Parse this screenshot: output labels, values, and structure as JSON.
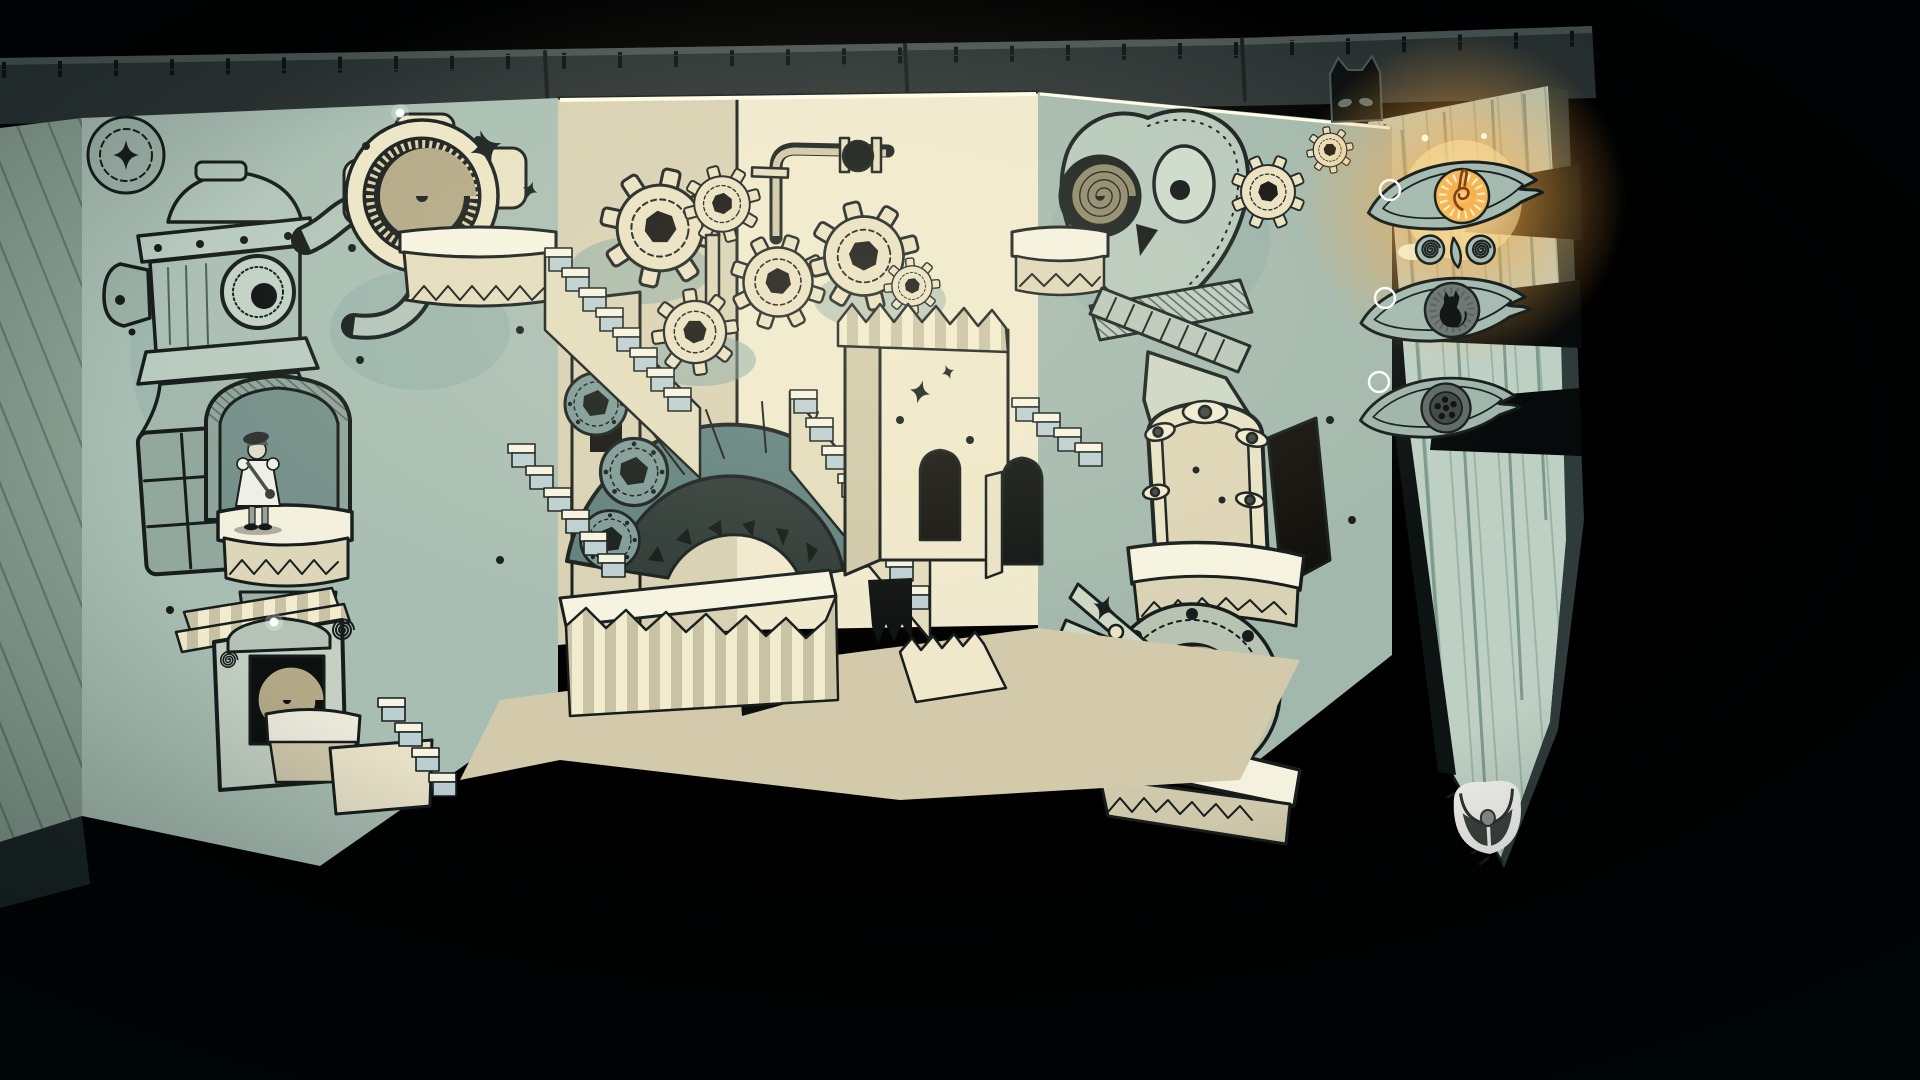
{
  "colors": {
    "background": "#000000",
    "cover_band": "#2a3232",
    "cover_edge": "#4a5452",
    "cover_tick": "#0d1312",
    "left_page_edge": "#8aa093",
    "left_wall": "#a9beb3",
    "back_wall_lit": "#f0e9cd",
    "back_wall_shade": "#d8d0b2",
    "right_wall": "#a3b8ad",
    "floor": "#d3caab",
    "paper_white": "#f6f3e1",
    "cream": "#e6dec0",
    "cream_shadow": "#c9c2a6",
    "shadow_blue": "#7ea1a1",
    "stair_side": "#bccfd2",
    "teal_arch": "#5f7f7d",
    "teal_disc": "#7d9996",
    "ink": "#161d1c",
    "tan_spiral": "#b3a987",
    "dark_disc": "#191f1d",
    "right_page": "#bed0c4",
    "page_edge_side": "#2f3b3a",
    "ribbon_black": "#060a0a",
    "glow_outer": "#f6a844",
    "glow_core": "#ffe09a",
    "eye_body": "#a4bab0",
    "iris_grey": "#6b7573",
    "iris_plate": "#3f4745",
    "ring_white": "#ffffff",
    "cat_tab_black": "#0b0f0f",
    "cat_tab_eye": "#5c6f6a",
    "bag_white": "#f2f2ee",
    "bag_dark": "#3b403c",
    "bag_clasp": "#8a8f8a",
    "girl_dress": "#eef0e6",
    "girl_hat": "#2e3332",
    "girl_skin": "#e2dcca",
    "girl_sock": "#98a29b",
    "glint": "#ffffff"
  },
  "hud": {
    "bookmarks": [
      {
        "icon": "eye-of-horus-music-bookmark",
        "state": "lit",
        "has_ring": true
      },
      {
        "icon": "eye-of-horus-cat-bookmark",
        "state": "dim",
        "has_ring": true
      },
      {
        "icon": "eye-of-horus-reel-bookmark",
        "state": "dim",
        "has_ring": true
      }
    ],
    "cat_tab": {
      "icon": "black-cat-bookmark-tab"
    },
    "inventory": {
      "icon": "satchel-bag-icon"
    }
  },
  "scene": {
    "features": [
      "pop-up-book-diorama",
      "robot-hydrant-face",
      "spiral-disc-machine",
      "girl-character-on-platform",
      "window-frame",
      "spiral-portal-frame",
      "paper-gears",
      "pipe-frame-valve",
      "grand-teal-arch",
      "paper-staircases",
      "accordion-folds",
      "owl-face-machine",
      "eye-arch-door",
      "scissor-lever",
      "spiral-wheel",
      "glint-dots",
      "sparkles"
    ]
  }
}
